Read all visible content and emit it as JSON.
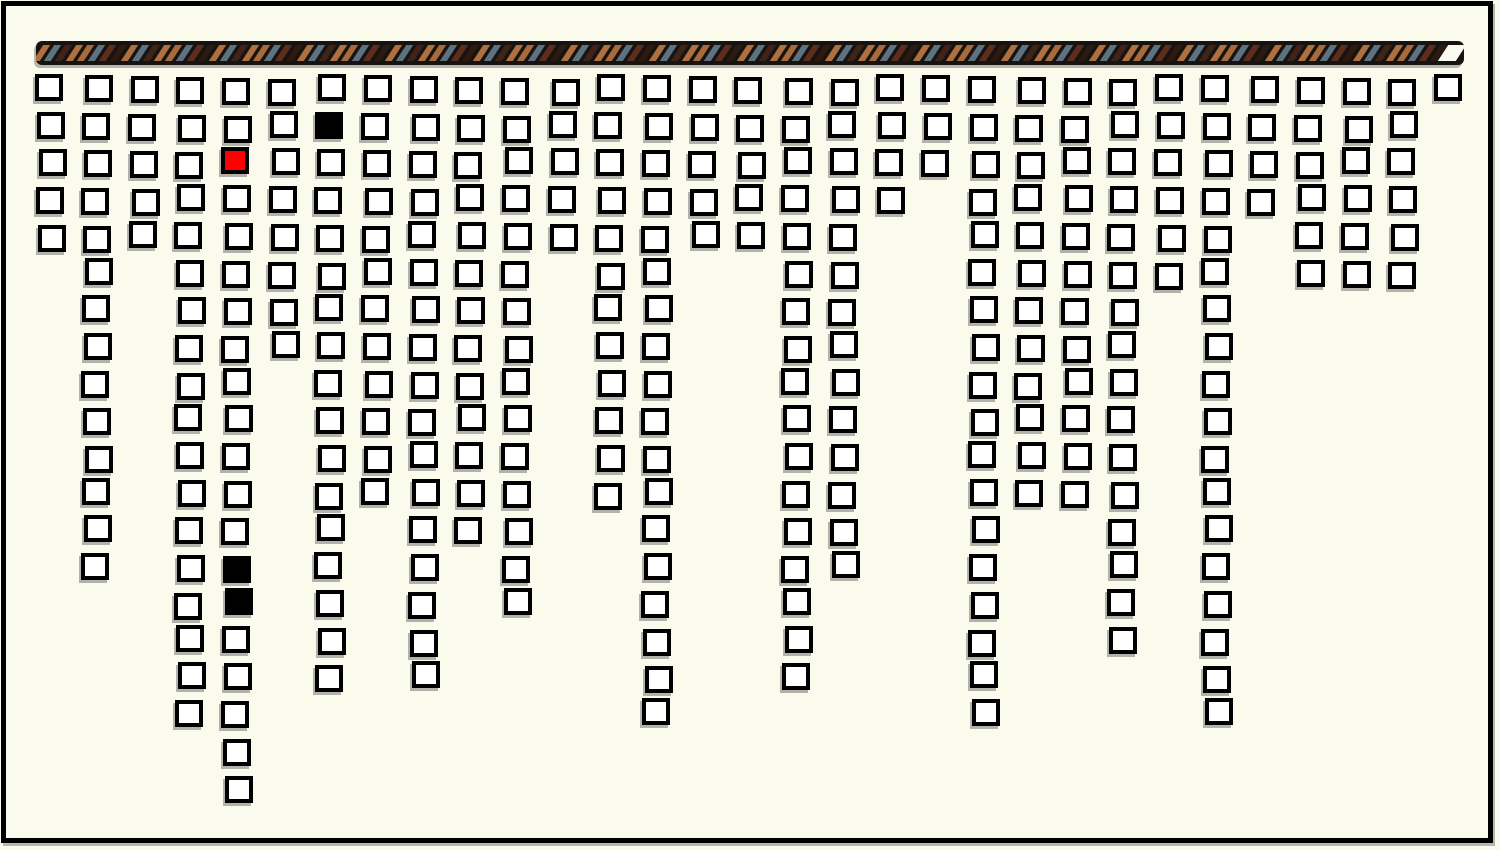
{
  "canvas": {
    "background": "#fafaed",
    "frame_border_color": "#000000",
    "frame_shadow_color": "#b7b7ae"
  },
  "progress_bar": {
    "track_color": "#171310",
    "border_color": "#000000",
    "stripe_colors": [
      "#b06f3f",
      "#5d7180",
      "#3f2318",
      "#b06f3f",
      "#aa693d",
      "#5d7180",
      "#5f2d1b",
      "#2c1a10"
    ],
    "end_gap_color": "#fbfaee"
  },
  "board": {
    "cell_fill": "#ffffff",
    "cell_border": "#000000",
    "cell_shadow": "#b2b2aa",
    "column_heights": [
      5,
      14,
      5,
      18,
      20,
      8,
      17,
      12,
      17,
      13,
      15,
      5,
      12,
      18,
      5,
      5,
      17,
      14,
      4,
      3,
      18,
      12,
      12,
      16,
      6,
      18,
      4,
      6,
      6,
      6,
      1
    ],
    "special_cells": [
      {
        "col": 6,
        "row": 1,
        "fill": "#000000",
        "name": "black-cell"
      },
      {
        "col": 4,
        "row": 2,
        "fill": "#fe0000",
        "name": "red-cell"
      },
      {
        "col": 4,
        "row": 13,
        "fill": "#000000",
        "name": "black-cell"
      },
      {
        "col": 4,
        "row": 14,
        "fill": "#000000",
        "name": "black-cell"
      }
    ]
  },
  "chart_data": {
    "type": "bar",
    "subtype": "top-hung waffle columns (one outlined square per unit)",
    "categories": [
      1,
      2,
      3,
      4,
      5,
      6,
      7,
      8,
      9,
      10,
      11,
      12,
      13,
      14,
      15,
      16,
      17,
      18,
      19,
      20,
      21,
      22,
      23,
      24,
      25,
      26,
      27,
      28,
      29,
      30,
      31
    ],
    "values": [
      5,
      14,
      5,
      18,
      20,
      8,
      17,
      12,
      17,
      13,
      15,
      5,
      12,
      18,
      5,
      5,
      17,
      14,
      4,
      3,
      18,
      12,
      12,
      16,
      6,
      18,
      4,
      6,
      6,
      6,
      1
    ],
    "ylim": [
      0,
      20
    ],
    "title": "",
    "xlabel": "",
    "ylabel": "",
    "grid": "off",
    "legend": "none",
    "annotations": [
      {
        "cell": [
          6,
          1
        ],
        "color": "black"
      },
      {
        "cell": [
          4,
          2
        ],
        "color": "red"
      },
      {
        "cell": [
          4,
          13
        ],
        "color": "black"
      },
      {
        "cell": [
          4,
          14
        ],
        "color": "black"
      }
    ]
  }
}
